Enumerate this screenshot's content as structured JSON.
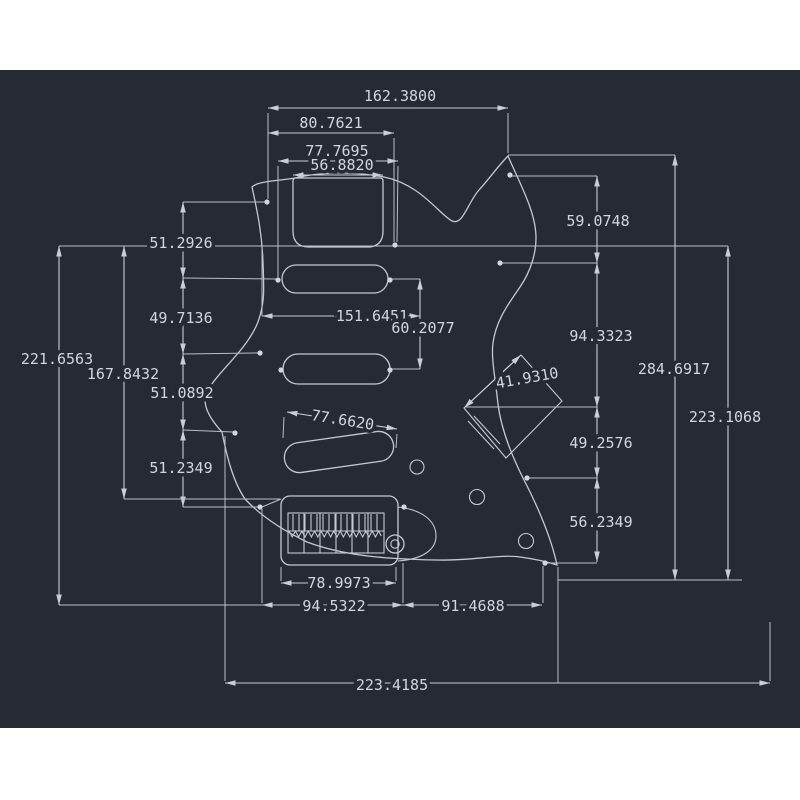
{
  "scene": {
    "type": "cad-technical-drawing",
    "subject": "Stratocaster-style guitar pickguard dimension drawing",
    "background_color": "#252a33",
    "margin_color": "#ffffff",
    "line_color": "#c9ced5",
    "text_color": "#d2d7de"
  },
  "dims": {
    "d162": {
      "label": "162.3800"
    },
    "d80": {
      "label": "80.7621"
    },
    "d77a": {
      "label": "77.7695"
    },
    "d56a": {
      "label": "56.8820"
    },
    "d51a": {
      "label": "51.2926"
    },
    "d49a": {
      "label": "49.7136"
    },
    "d167": {
      "label": "167.8432"
    },
    "d221": {
      "label": "221.6563"
    },
    "d51b": {
      "label": "51.0892"
    },
    "d51c": {
      "label": "51.2349"
    },
    "d151": {
      "label": "151.6451"
    },
    "d60": {
      "label": "60.2077"
    },
    "d77b": {
      "label": "77.6620"
    },
    "d41": {
      "label": "41.9310"
    },
    "d59": {
      "label": "59.0748"
    },
    "d94a": {
      "label": "94.3323"
    },
    "d284": {
      "label": "284.6917"
    },
    "d223a": {
      "label": "223.1068"
    },
    "d49b": {
      "label": "49.2576"
    },
    "d56b": {
      "label": "56.2349"
    },
    "d78": {
      "label": "78.9973"
    },
    "d94b": {
      "label": "94.5322"
    },
    "d91": {
      "label": "91.4688"
    },
    "d223b": {
      "label": "223.4185"
    }
  }
}
